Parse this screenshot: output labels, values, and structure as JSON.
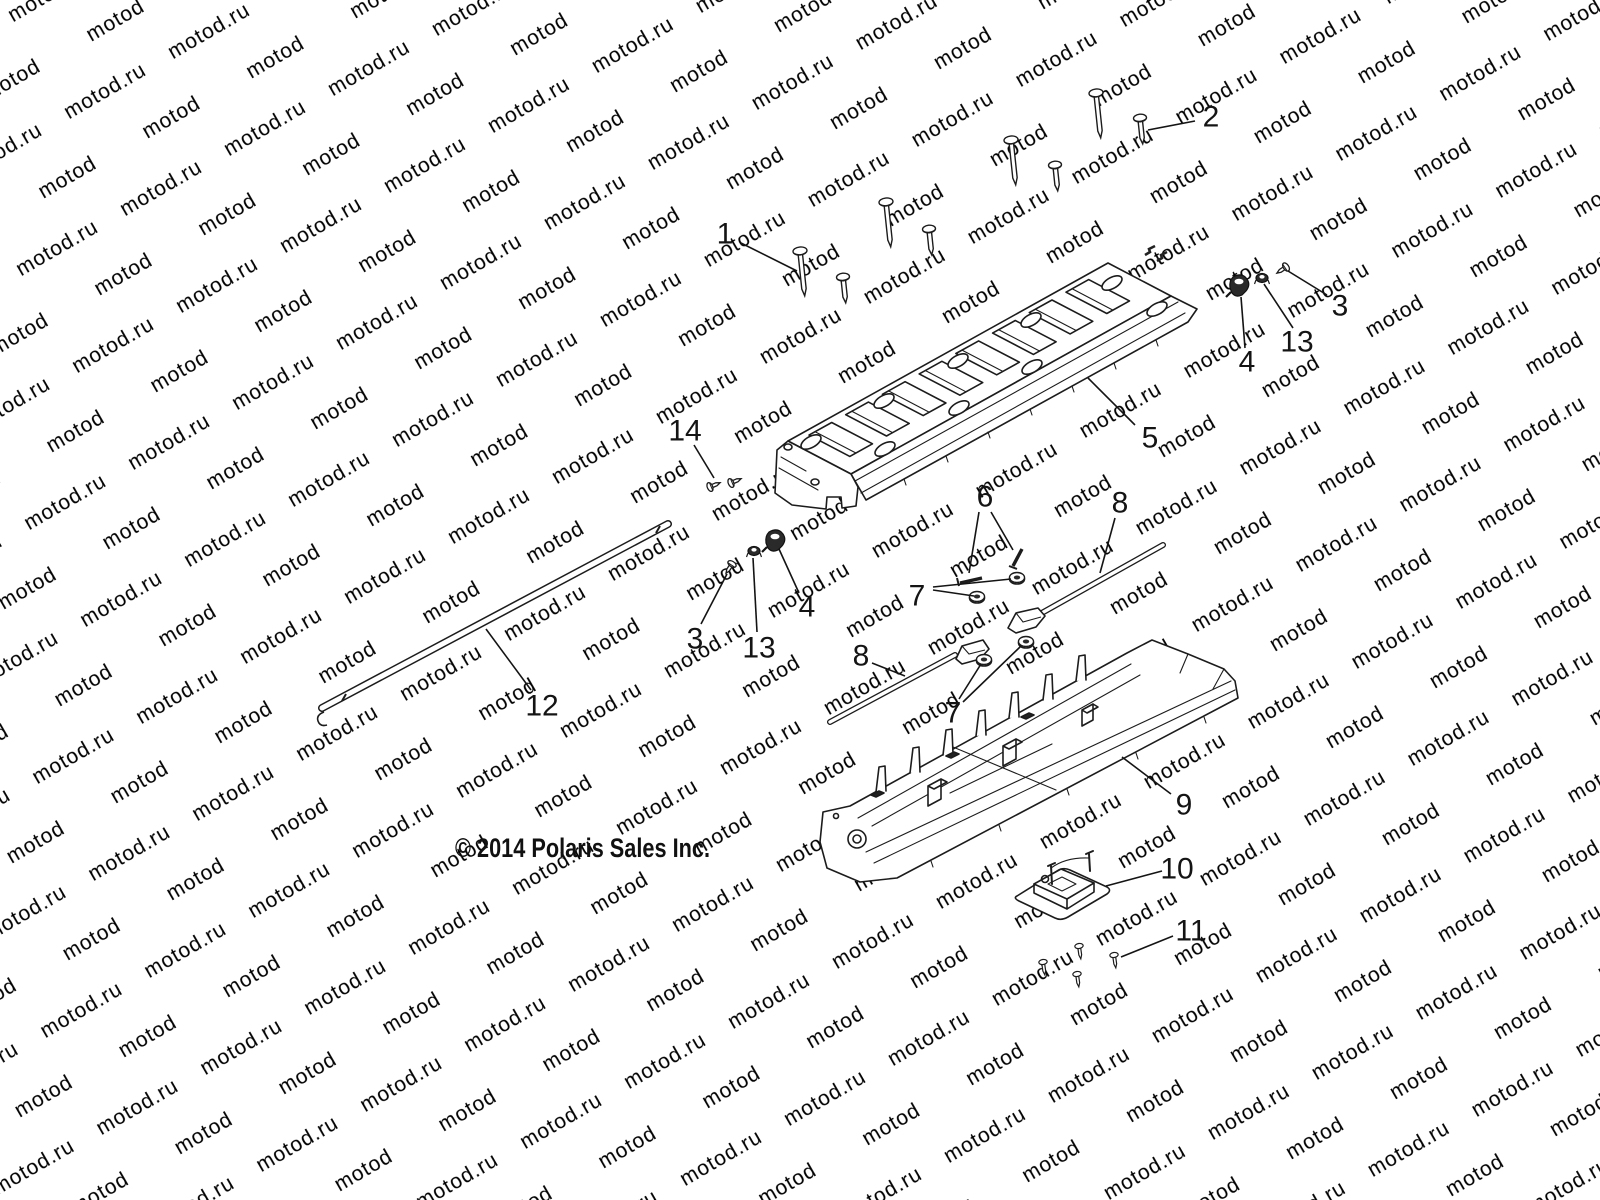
{
  "watermark": {
    "text": "motod.ru",
    "color": "#dcdcdc",
    "font_size": 21,
    "angle_deg": -30
  },
  "footer": {
    "copyright": "© 2014 Polaris Sales Inc."
  },
  "diagram": {
    "description": "exploded-parts-view",
    "line_color": "#141414",
    "callout_font_size": 30,
    "callouts": [
      {
        "label": "1",
        "x": 725,
        "y": 234,
        "leaders": [
          [
            741,
            243,
            797,
            271
          ]
        ]
      },
      {
        "label": "2",
        "x": 1211,
        "y": 117,
        "leaders": [
          [
            1195,
            121,
            1148,
            130
          ]
        ]
      },
      {
        "label": "3",
        "x": 1340,
        "y": 306,
        "leaders": [
          [
            1327,
            295,
            1288,
            271
          ]
        ]
      },
      {
        "label": "13",
        "x": 1297,
        "y": 342,
        "leaders": [
          [
            1293,
            328,
            1264,
            284
          ]
        ]
      },
      {
        "label": "4",
        "x": 1247,
        "y": 362,
        "leaders": [
          [
            1245,
            348,
            1241,
            297
          ]
        ]
      },
      {
        "label": "5",
        "x": 1150,
        "y": 438,
        "leaders": [
          [
            1135,
            425,
            1088,
            378
          ]
        ]
      },
      {
        "label": "14",
        "x": 685,
        "y": 431,
        "leaders": [
          [
            694,
            445,
            714,
            478
          ]
        ]
      },
      {
        "label": "6",
        "x": 985,
        "y": 497,
        "leaders": [
          [
            979,
            512,
            969,
            573
          ],
          [
            991,
            512,
            1013,
            550
          ]
        ]
      },
      {
        "label": "8",
        "x": 1120,
        "y": 503,
        "leaders": [
          [
            1115,
            518,
            1100,
            573
          ]
        ]
      },
      {
        "label": "7",
        "x": 917,
        "y": 596,
        "leaders": [
          [
            933,
            590,
            974,
            596
          ],
          [
            933,
            587,
            1011,
            579
          ]
        ]
      },
      {
        "label": "3",
        "x": 695,
        "y": 639,
        "leaders": [
          [
            701,
            624,
            727,
            574
          ]
        ]
      },
      {
        "label": "13",
        "x": 759,
        "y": 648,
        "leaders": [
          [
            757,
            632,
            753,
            558
          ]
        ]
      },
      {
        "label": "4",
        "x": 807,
        "y": 607,
        "leaders": [
          [
            799,
            593,
            779,
            549
          ]
        ]
      },
      {
        "label": "8",
        "x": 861,
        "y": 656,
        "leaders": [
          [
            872,
            663,
            905,
            676
          ]
        ]
      },
      {
        "label": "7",
        "x": 953,
        "y": 713,
        "leaders": [
          [
            959,
            699,
            981,
            664
          ],
          [
            963,
            702,
            1021,
            646
          ]
        ]
      },
      {
        "label": "12",
        "x": 542,
        "y": 706,
        "leaders": [
          [
            531,
            690,
            486,
            629
          ]
        ]
      },
      {
        "label": "9",
        "x": 1184,
        "y": 805,
        "leaders": [
          [
            1171,
            794,
            1122,
            757
          ]
        ]
      },
      {
        "label": "10",
        "x": 1177,
        "y": 869,
        "leaders": [
          [
            1162,
            871,
            1106,
            886
          ]
        ]
      },
      {
        "label": "11",
        "x": 1191,
        "y": 931,
        "leaders": [
          [
            1173,
            936,
            1121,
            957
          ]
        ]
      }
    ]
  }
}
